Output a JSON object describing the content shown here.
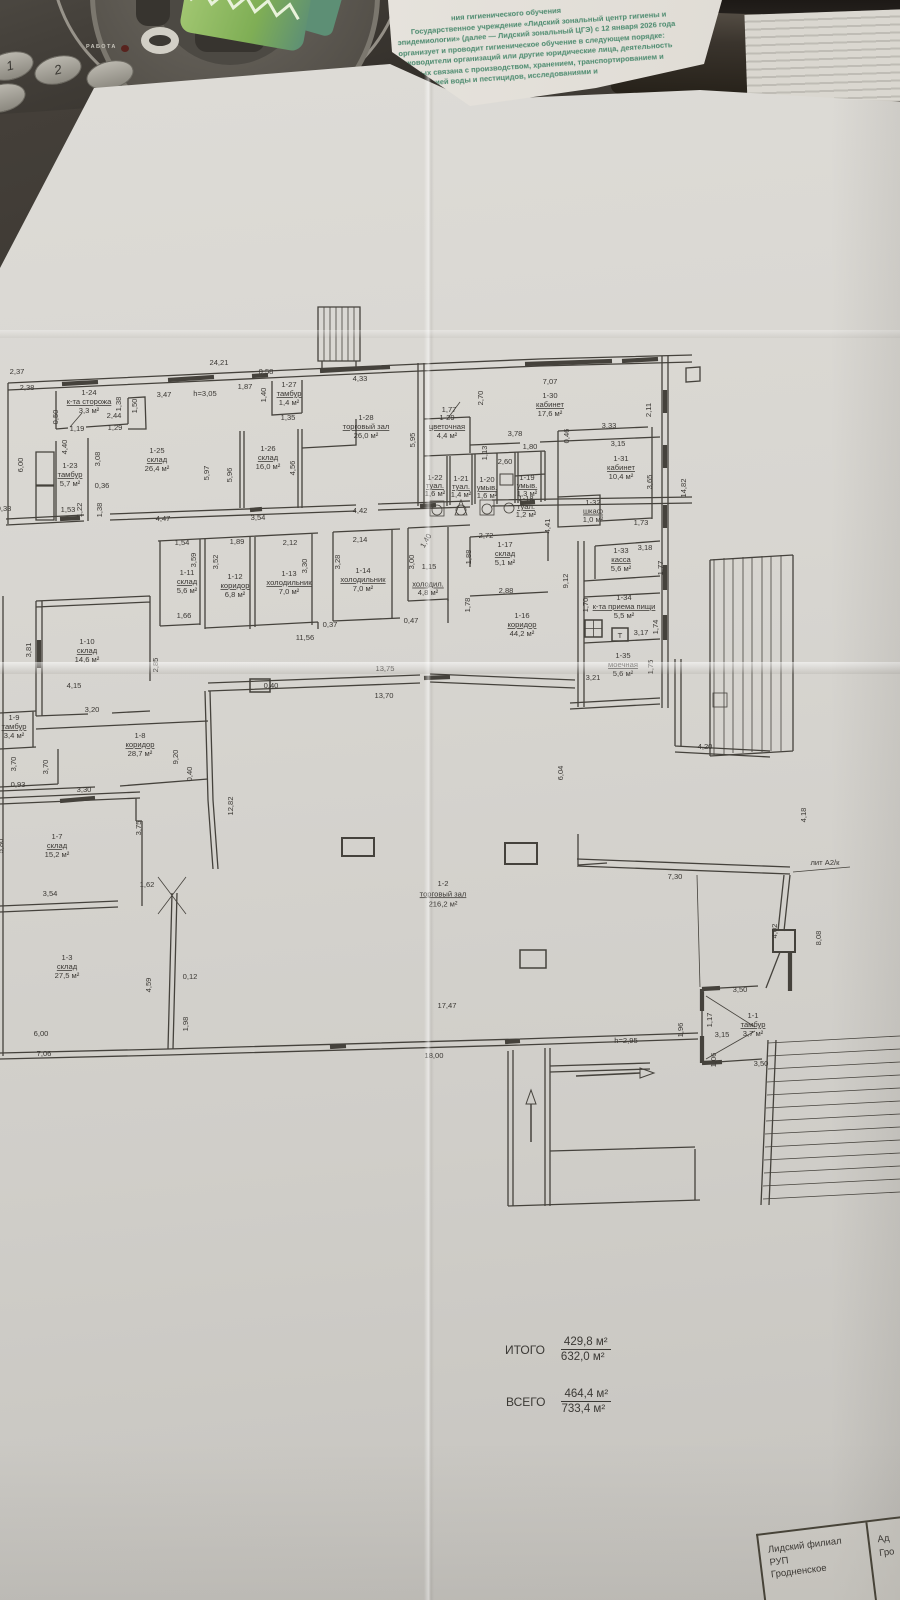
{
  "photo": {
    "phone_label": "РАБОТА",
    "phone_keys": [
      "1",
      "2",
      ""
    ]
  },
  "colors": {
    "paper": "#d8d6d1",
    "ink": "#3b3834",
    "stamp_green": "#4b8a6e",
    "desk_dark": "#2b2723",
    "green_object": "#7fae55"
  },
  "stamp": {
    "lines": [
      "ния гигиенического обучения",
      "Государственное учреждение «Лидский зональный центр гигиены и",
      "эпидемиологии» (далее — Лидский зональный ЦГЭ) с 12 января 2026 года",
      "организует и проводит гигиеническое обучение в следующем порядке:",
      "руководители организаций или другие юридические лица, деятельность",
      "которых связана с производством, хранением, транспортированием и",
      "реализацией воды и пестицидов, исследованиями и"
    ]
  },
  "plan": {
    "rooms": [
      {
        "id": "1-1",
        "name": "тамбур",
        "area": "3,7 м²",
        "x": 753,
        "y": 1018
      },
      {
        "id": "1-2",
        "name": "торговый зал",
        "area": "216,2 м²",
        "x": 443,
        "y": 886,
        "s": 8.5
      },
      {
        "id": "1-3",
        "name": "склад",
        "area": "27,5 м²",
        "x": 67,
        "y": 960
      },
      {
        "id": "1-7",
        "name": "склад",
        "area": "15,2 м²",
        "x": 57,
        "y": 839
      },
      {
        "id": "1-8",
        "name": "коридор",
        "area": "28,7 м²",
        "x": 140,
        "y": 738
      },
      {
        "id": "1-9",
        "name": "тамбур",
        "area": "3,4 м²",
        "x": 14,
        "y": 720
      },
      {
        "id": "1-10",
        "name": "склад",
        "area": "14,6 м²",
        "x": 87,
        "y": 644
      },
      {
        "id": "1-11",
        "name": "склад",
        "area": "5,6 м²",
        "x": 187,
        "y": 575
      },
      {
        "id": "1-12",
        "name": "коридор",
        "area": "6,8 м²",
        "x": 235,
        "y": 579
      },
      {
        "id": "1-13",
        "name": "холодильник",
        "area": "7,0 м²",
        "x": 289,
        "y": 576
      },
      {
        "id": "1-14",
        "name": "холодильник",
        "area": "7,0 м²",
        "x": 363,
        "y": 573
      },
      {
        "id": "",
        "name": "холодил.",
        "area": "4,8 м²",
        "x": 428,
        "y": 578,
        "s": 6.8
      },
      {
        "id": "1-16",
        "name": "коридор",
        "area": "44,2 м²",
        "x": 522,
        "y": 618
      },
      {
        "id": "1-17",
        "name": "склад",
        "area": "5,1 м²",
        "x": 505,
        "y": 547
      },
      {
        "id": "1-18",
        "name": "туал.",
        "area": "1,2 м²",
        "x": 526,
        "y": 501,
        "s": 6.2
      },
      {
        "id": "1-19",
        "name": "умыв.",
        "area": "1,3 м²",
        "x": 527,
        "y": 480,
        "s": 6.2
      },
      {
        "id": "1-20",
        "name": "умыв.",
        "area": "1,6 м²",
        "x": 487,
        "y": 482,
        "s": 6.2
      },
      {
        "id": "1-21",
        "name": "туал.",
        "area": "1,4 м²",
        "x": 461,
        "y": 481,
        "s": 6.2
      },
      {
        "id": "1-22",
        "name": "туал.",
        "area": "1,6 м²",
        "x": 435,
        "y": 480,
        "s": 6.2
      },
      {
        "id": "1-23",
        "name": "тамбур",
        "area": "5,7 м²",
        "x": 70,
        "y": 468
      },
      {
        "id": "1-24",
        "name": "к-та сторожа",
        "area": "3,3 м²",
        "x": 89,
        "y": 395
      },
      {
        "id": "1-25",
        "name": "склад",
        "area": "26,4 м²",
        "x": 157,
        "y": 453
      },
      {
        "id": "1-26",
        "name": "склад",
        "area": "16,0 м²",
        "x": 268,
        "y": 451
      },
      {
        "id": "1-27",
        "name": "тамбур",
        "area": "1,4 м²",
        "x": 289,
        "y": 387
      },
      {
        "id": "1-28",
        "name": "торговый зал",
        "area": "26,0 м²",
        "x": 366,
        "y": 420
      },
      {
        "id": "1-29",
        "name": "цветочная",
        "area": "4,4 м²",
        "x": 447,
        "y": 420
      },
      {
        "id": "1-30",
        "name": "кабинет",
        "area": "17,6 м²",
        "x": 550,
        "y": 398
      },
      {
        "id": "1-31",
        "name": "кабинет",
        "area": "10,4 м²",
        "x": 621,
        "y": 461
      },
      {
        "id": "1-32",
        "name": "шкаф",
        "area": "1,0 м²",
        "x": 593,
        "y": 505,
        "s": 6.8
      },
      {
        "id": "1-33",
        "name": "касса",
        "area": "5,6 м²",
        "x": 621,
        "y": 553
      },
      {
        "id": "1-34",
        "name": "к-та приема пищи",
        "area": "5,5 м²",
        "x": 624,
        "y": 600
      },
      {
        "id": "1-35",
        "name": "моечная",
        "area": "5,6 м²",
        "x": 623,
        "y": 658
      }
    ],
    "dims": [
      {
        "t": "2,37",
        "x": 17,
        "y": 374
      },
      {
        "t": "2,38",
        "x": 27,
        "y": 390
      },
      {
        "t": "24,21",
        "x": 219,
        "y": 365
      },
      {
        "t": "0,58",
        "x": 266,
        "y": 374
      },
      {
        "t": "1,87",
        "x": 245,
        "y": 389
      },
      {
        "t": "h=3,05",
        "x": 205,
        "y": 396
      },
      {
        "t": "3,47",
        "x": 164,
        "y": 397
      },
      {
        "t": "1,38",
        "x": 121,
        "y": 404,
        "r": -90
      },
      {
        "t": "1,50",
        "x": 137,
        "y": 406,
        "r": -90
      },
      {
        "t": "2,44",
        "x": 114,
        "y": 418
      },
      {
        "t": "1,19",
        "x": 77,
        "y": 431
      },
      {
        "t": "1,29",
        "x": 115,
        "y": 430
      },
      {
        "t": "0,50",
        "x": 58,
        "y": 417,
        "r": -90
      },
      {
        "t": "1,40",
        "x": 266,
        "y": 395,
        "r": -90
      },
      {
        "t": "1,35",
        "x": 288,
        "y": 420
      },
      {
        "t": "4,33",
        "x": 360,
        "y": 381
      },
      {
        "t": "1,77",
        "x": 449,
        "y": 412
      },
      {
        "t": "2,70",
        "x": 483,
        "y": 398,
        "r": -90
      },
      {
        "t": "7,07",
        "x": 550,
        "y": 384
      },
      {
        "t": "3,78",
        "x": 515,
        "y": 436
      },
      {
        "t": "1,80",
        "x": 530,
        "y": 449
      },
      {
        "t": "2,60",
        "x": 505,
        "y": 464
      },
      {
        "t": "1,13",
        "x": 487,
        "y": 453,
        "r": -90
      },
      {
        "t": "0,46",
        "x": 569,
        "y": 436,
        "r": -90
      },
      {
        "t": "3,33",
        "x": 609,
        "y": 428
      },
      {
        "t": "3,15",
        "x": 618,
        "y": 446
      },
      {
        "t": "2,11",
        "x": 651,
        "y": 410,
        "r": -90
      },
      {
        "t": "3,65",
        "x": 652,
        "y": 482,
        "r": -90
      },
      {
        "t": "14,82",
        "x": 686,
        "y": 488,
        "r": -90
      },
      {
        "t": "1,73",
        "x": 641,
        "y": 525
      },
      {
        "t": "6,00",
        "x": 23,
        "y": 465,
        "r": -90
      },
      {
        "t": "4,40",
        "x": 67,
        "y": 447,
        "r": -90
      },
      {
        "t": "3,08",
        "x": 100,
        "y": 459,
        "r": -90
      },
      {
        "t": "0,36",
        "x": 102,
        "y": 488
      },
      {
        "t": "1,53",
        "x": 68,
        "y": 512
      },
      {
        "t": "1,22",
        "x": 82,
        "y": 510,
        "r": -90
      },
      {
        "t": "1,38",
        "x": 102,
        "y": 510,
        "r": -90
      },
      {
        "t": "0,33",
        "x": 4,
        "y": 511
      },
      {
        "t": "5,97",
        "x": 209,
        "y": 473,
        "r": -90
      },
      {
        "t": "5,96",
        "x": 232,
        "y": 475,
        "r": -90
      },
      {
        "t": "4,56",
        "x": 295,
        "y": 468,
        "r": -90
      },
      {
        "t": "4,47",
        "x": 163,
        "y": 521
      },
      {
        "t": "3,54",
        "x": 258,
        "y": 520
      },
      {
        "t": "4,42",
        "x": 360,
        "y": 513
      },
      {
        "t": "5,95",
        "x": 415,
        "y": 440,
        "r": -90
      },
      {
        "t": "1,54",
        "x": 182,
        "y": 545
      },
      {
        "t": "3,59",
        "x": 196,
        "y": 560,
        "r": -90
      },
      {
        "t": "1,89",
        "x": 237,
        "y": 544
      },
      {
        "t": "3,52",
        "x": 218,
        "y": 562,
        "r": -90
      },
      {
        "t": "2,12",
        "x": 290,
        "y": 545
      },
      {
        "t": "3,30",
        "x": 307,
        "y": 566,
        "r": -90
      },
      {
        "t": "2,14",
        "x": 360,
        "y": 542
      },
      {
        "t": "3,28",
        "x": 340,
        "y": 562,
        "r": -90
      },
      {
        "t": "1,40",
        "x": 428,
        "y": 542,
        "r": -60
      },
      {
        "t": "3,00",
        "x": 414,
        "y": 562,
        "r": -90
      },
      {
        "t": "1,15",
        "x": 429,
        "y": 569
      },
      {
        "t": "1,88",
        "x": 471,
        "y": 557,
        "r": -90
      },
      {
        "t": "1,78",
        "x": 470,
        "y": 605,
        "r": -90
      },
      {
        "t": "1,66",
        "x": 184,
        "y": 618
      },
      {
        "t": "0,37",
        "x": 330,
        "y": 627
      },
      {
        "t": "0,47",
        "x": 411,
        "y": 623
      },
      {
        "t": "11,56",
        "x": 305,
        "y": 640
      },
      {
        "t": "2,72",
        "x": 486,
        "y": 538
      },
      {
        "t": "2,88",
        "x": 506,
        "y": 593
      },
      {
        "t": "4,41",
        "x": 550,
        "y": 526,
        "r": -90
      },
      {
        "t": "9,12",
        "x": 568,
        "y": 581,
        "r": -90
      },
      {
        "t": "3,18",
        "x": 645,
        "y": 550
      },
      {
        "t": "1,77",
        "x": 663,
        "y": 568,
        "r": -90
      },
      {
        "t": "1,70",
        "x": 588,
        "y": 605,
        "r": -90
      },
      {
        "t": "1,74",
        "x": 658,
        "y": 627,
        "r": -90
      },
      {
        "t": "3,17",
        "x": 641,
        "y": 635
      },
      {
        "t": "Т",
        "x": 620,
        "y": 638
      },
      {
        "t": "1,75",
        "x": 653,
        "y": 667,
        "r": -90
      },
      {
        "t": "3,21",
        "x": 593,
        "y": 680
      },
      {
        "t": "13,75",
        "x": 385,
        "y": 671
      },
      {
        "t": "0,40",
        "x": 271,
        "y": 688
      },
      {
        "t": "13,70",
        "x": 384,
        "y": 698
      },
      {
        "t": "3,81",
        "x": 31,
        "y": 650,
        "r": -90
      },
      {
        "t": "4,15",
        "x": 74,
        "y": 688
      },
      {
        "t": "3,20",
        "x": 92,
        "y": 712
      },
      {
        "t": "2,85",
        "x": 158,
        "y": 665,
        "r": -90
      },
      {
        "t": "9,20",
        "x": 178,
        "y": 757,
        "r": -90
      },
      {
        "t": "0,40",
        "x": 192,
        "y": 774,
        "r": -90
      },
      {
        "t": "3,70",
        "x": 16,
        "y": 764,
        "r": -90
      },
      {
        "t": "3,70",
        "x": 48,
        "y": 767,
        "r": -90
      },
      {
        "t": "0,93",
        "x": 18,
        "y": 787
      },
      {
        "t": "3,30",
        "x": 84,
        "y": 792
      },
      {
        "t": "12,82",
        "x": 233,
        "y": 806,
        "r": -90
      },
      {
        "t": "3,75",
        "x": 141,
        "y": 828,
        "r": -90
      },
      {
        "t": "5,80",
        "x": 3,
        "y": 846,
        "r": -90
      },
      {
        "t": "3,54",
        "x": 50,
        "y": 896
      },
      {
        "t": "1,62",
        "x": 147,
        "y": 887
      },
      {
        "t": "4,59",
        "x": 151,
        "y": 985,
        "r": -90
      },
      {
        "t": "0,12",
        "x": 190,
        "y": 979
      },
      {
        "t": "1,98",
        "x": 188,
        "y": 1024,
        "r": -90
      },
      {
        "t": "6,00",
        "x": 41,
        "y": 1036
      },
      {
        "t": "7,06",
        "x": 44,
        "y": 1056
      },
      {
        "t": "17,47",
        "x": 447,
        "y": 1008
      },
      {
        "t": "18,00",
        "x": 434,
        "y": 1058
      },
      {
        "t": "h=2,95",
        "x": 626,
        "y": 1043
      },
      {
        "t": "6,04",
        "x": 563,
        "y": 773,
        "r": -90
      },
      {
        "t": "4,20",
        "x": 705,
        "y": 749
      },
      {
        "t": "4,18",
        "x": 806,
        "y": 815,
        "r": -90
      },
      {
        "t": "7,30",
        "x": 675,
        "y": 879
      },
      {
        "t": "лит А2/к",
        "x": 825,
        "y": 865
      },
      {
        "t": "4,02",
        "x": 777,
        "y": 931,
        "r": -90
      },
      {
        "t": "8,08",
        "x": 821,
        "y": 938,
        "r": -90
      },
      {
        "t": "3,50",
        "x": 740,
        "y": 992
      },
      {
        "t": "3,50",
        "x": 761,
        "y": 1066
      },
      {
        "t": "3,15",
        "x": 722,
        "y": 1037
      },
      {
        "t": "1,17",
        "x": 712,
        "y": 1020,
        "r": -90
      },
      {
        "t": "1,06",
        "x": 716,
        "y": 1060,
        "r": -90
      },
      {
        "t": "1,96",
        "x": 683,
        "y": 1030,
        "r": -90
      }
    ],
    "totals": {
      "itogo_label": "ИТОГО",
      "itogo_top": "429,8 м²",
      "itogo_bottom": "632,0 м²",
      "vsego_label": "ВСЕГО",
      "vsego_top": "464,4 м²",
      "vsego_bottom": "733,4 м²"
    },
    "titleblock": {
      "left_lines": [
        "Лидский филиал",
        "РУП",
        "Гродненское"
      ],
      "right_lines": [
        "Ад",
        "Гро"
      ]
    }
  }
}
